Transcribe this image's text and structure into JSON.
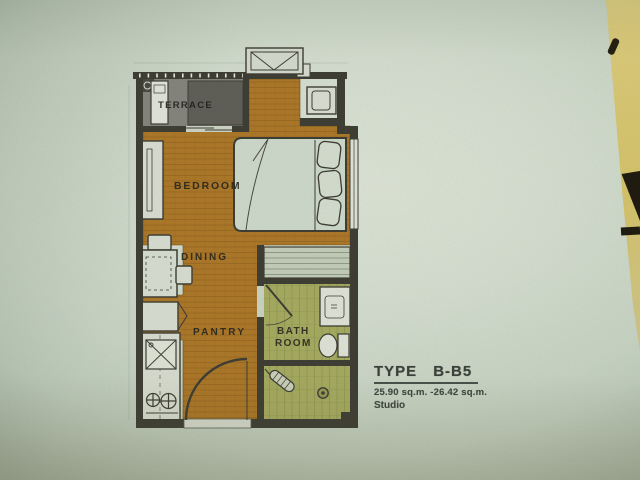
{
  "photo": {
    "paper_color": "#ccd7c8",
    "table_color": "#d4c57c"
  },
  "plan": {
    "room_labels": {
      "terrace": "TERRACE",
      "bedroom": "BEDROOM",
      "dining": "DINING",
      "pantry": "PANTRY",
      "bath_line1": "BATH",
      "bath_line2": "ROOM"
    },
    "colors": {
      "wood_floor": "#ab7524",
      "terrace_floor": "#84847c",
      "terrace_panel": "#5f5f58",
      "bath_floor": "#a5aa60",
      "wall": "#3e3e35"
    }
  },
  "title_block": {
    "type_label": "TYPE",
    "type_code": "B-B5",
    "area_range": "25.90 sq.m. -26.42 sq.m.",
    "unit_type": "Studio"
  }
}
